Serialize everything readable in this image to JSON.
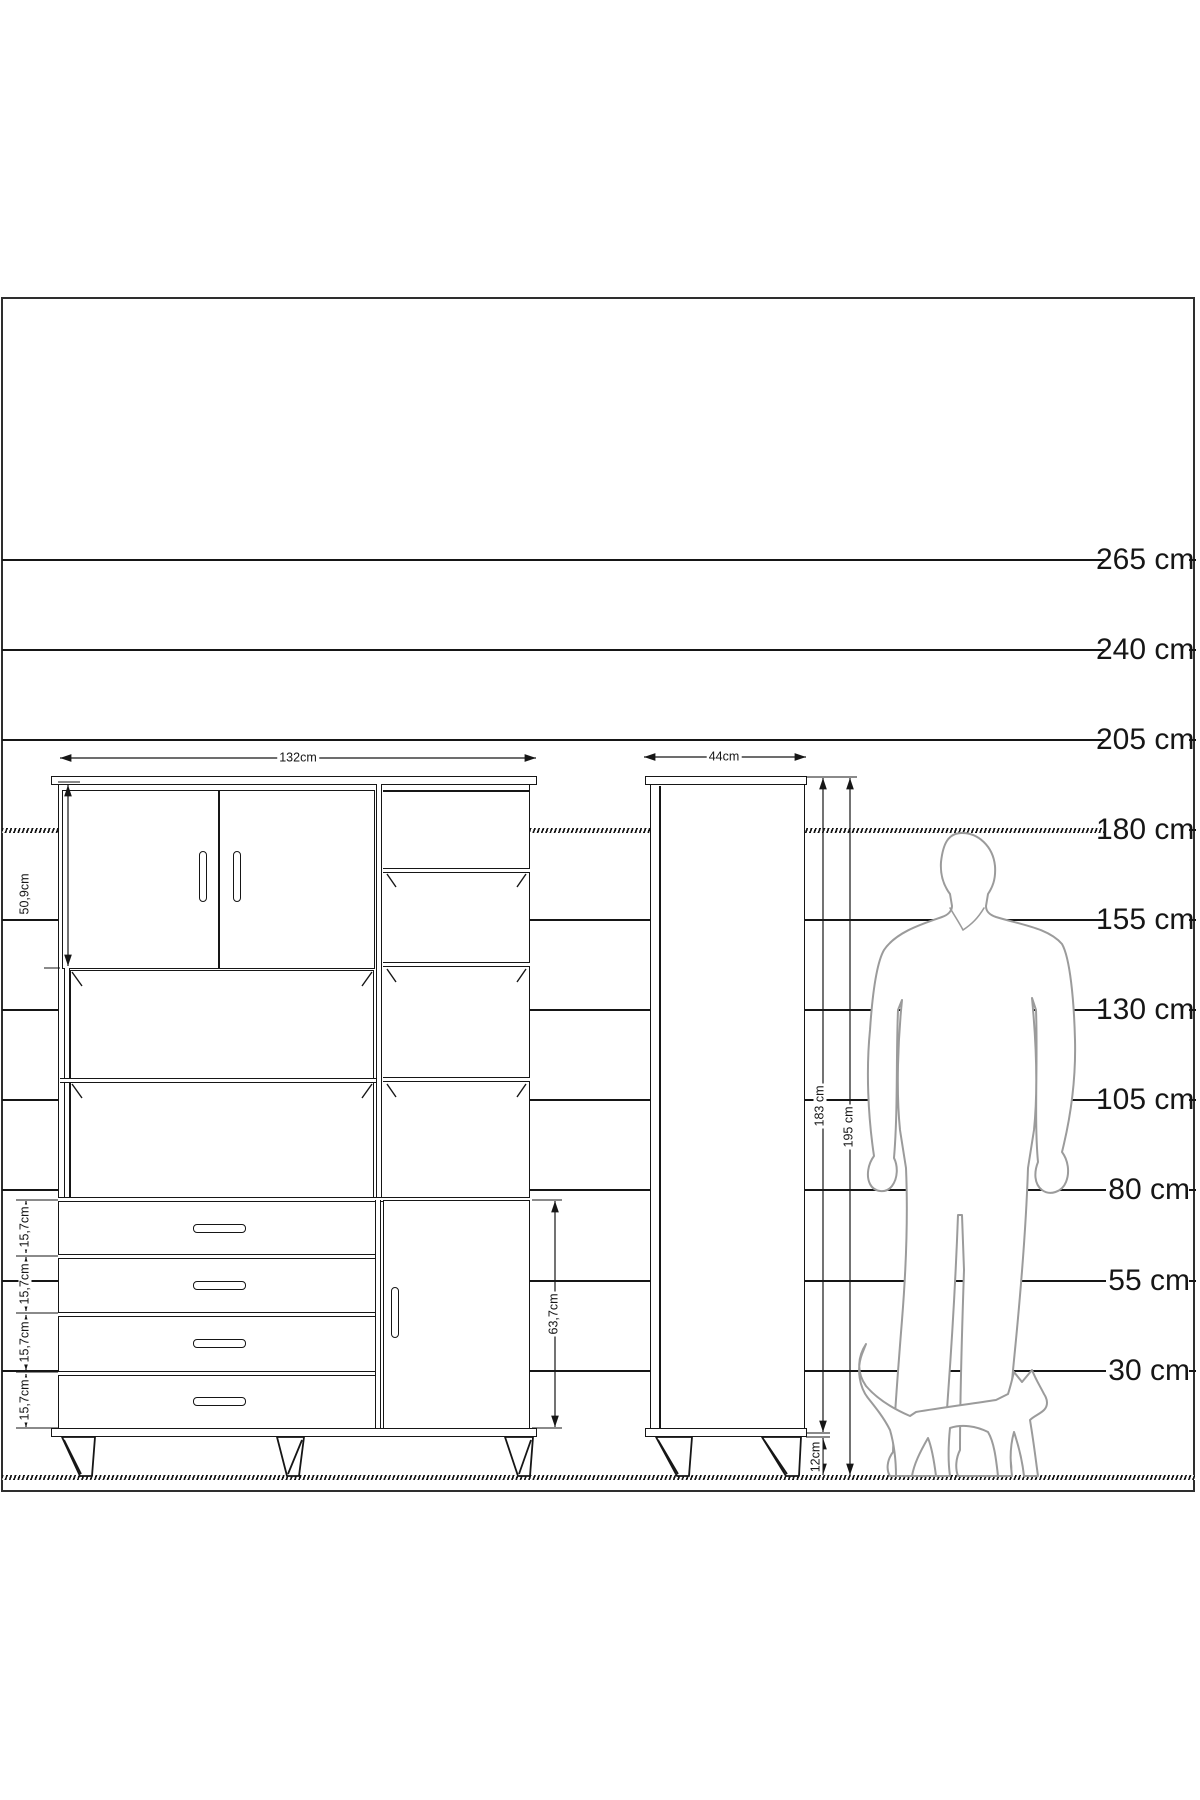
{
  "scale": {
    "labels": [
      "265 cm",
      "240 cm",
      "205 cm",
      "180 cm",
      "155 cm",
      "130 cm",
      "105 cm",
      "80 cm",
      "55 cm",
      "30 cm"
    ]
  },
  "dimensions": {
    "front_width": "132cm",
    "side_depth": "44cm",
    "upper_door_height": "50,9cm",
    "drawer_heights": [
      "15,7cm",
      "15,7cm",
      "15,7cm",
      "15,7cm"
    ],
    "lower_section_height": "63,7cm",
    "body_height": "183 cm",
    "total_height": "195 cm",
    "leg_height": "12cm"
  },
  "figures": {
    "man": "standing-man-silhouette",
    "cat": "walking-cat-silhouette"
  },
  "colors": {
    "line": "#161616",
    "silhouette": "#9b9b9b",
    "background": "#ffffff"
  }
}
